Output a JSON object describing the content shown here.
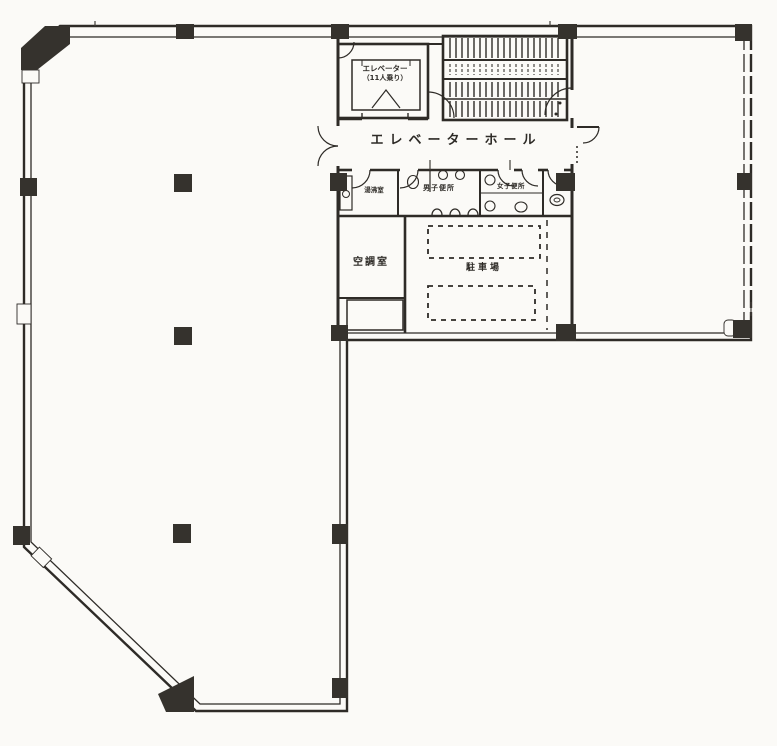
{
  "labels": {
    "elevator_hall": "エレベーターホール",
    "elevator_car_line1": "エレベーター",
    "elevator_car_line2": "（11人乗り）",
    "kitchenette": "湯沸室",
    "mens_toilet": "男子便所",
    "womens_toilet": "女子便所",
    "hvac_room": "空調室",
    "parking": "駐車場"
  },
  "colors": {
    "ink": "#2e2b27",
    "paper": "#fbfaf7"
  }
}
